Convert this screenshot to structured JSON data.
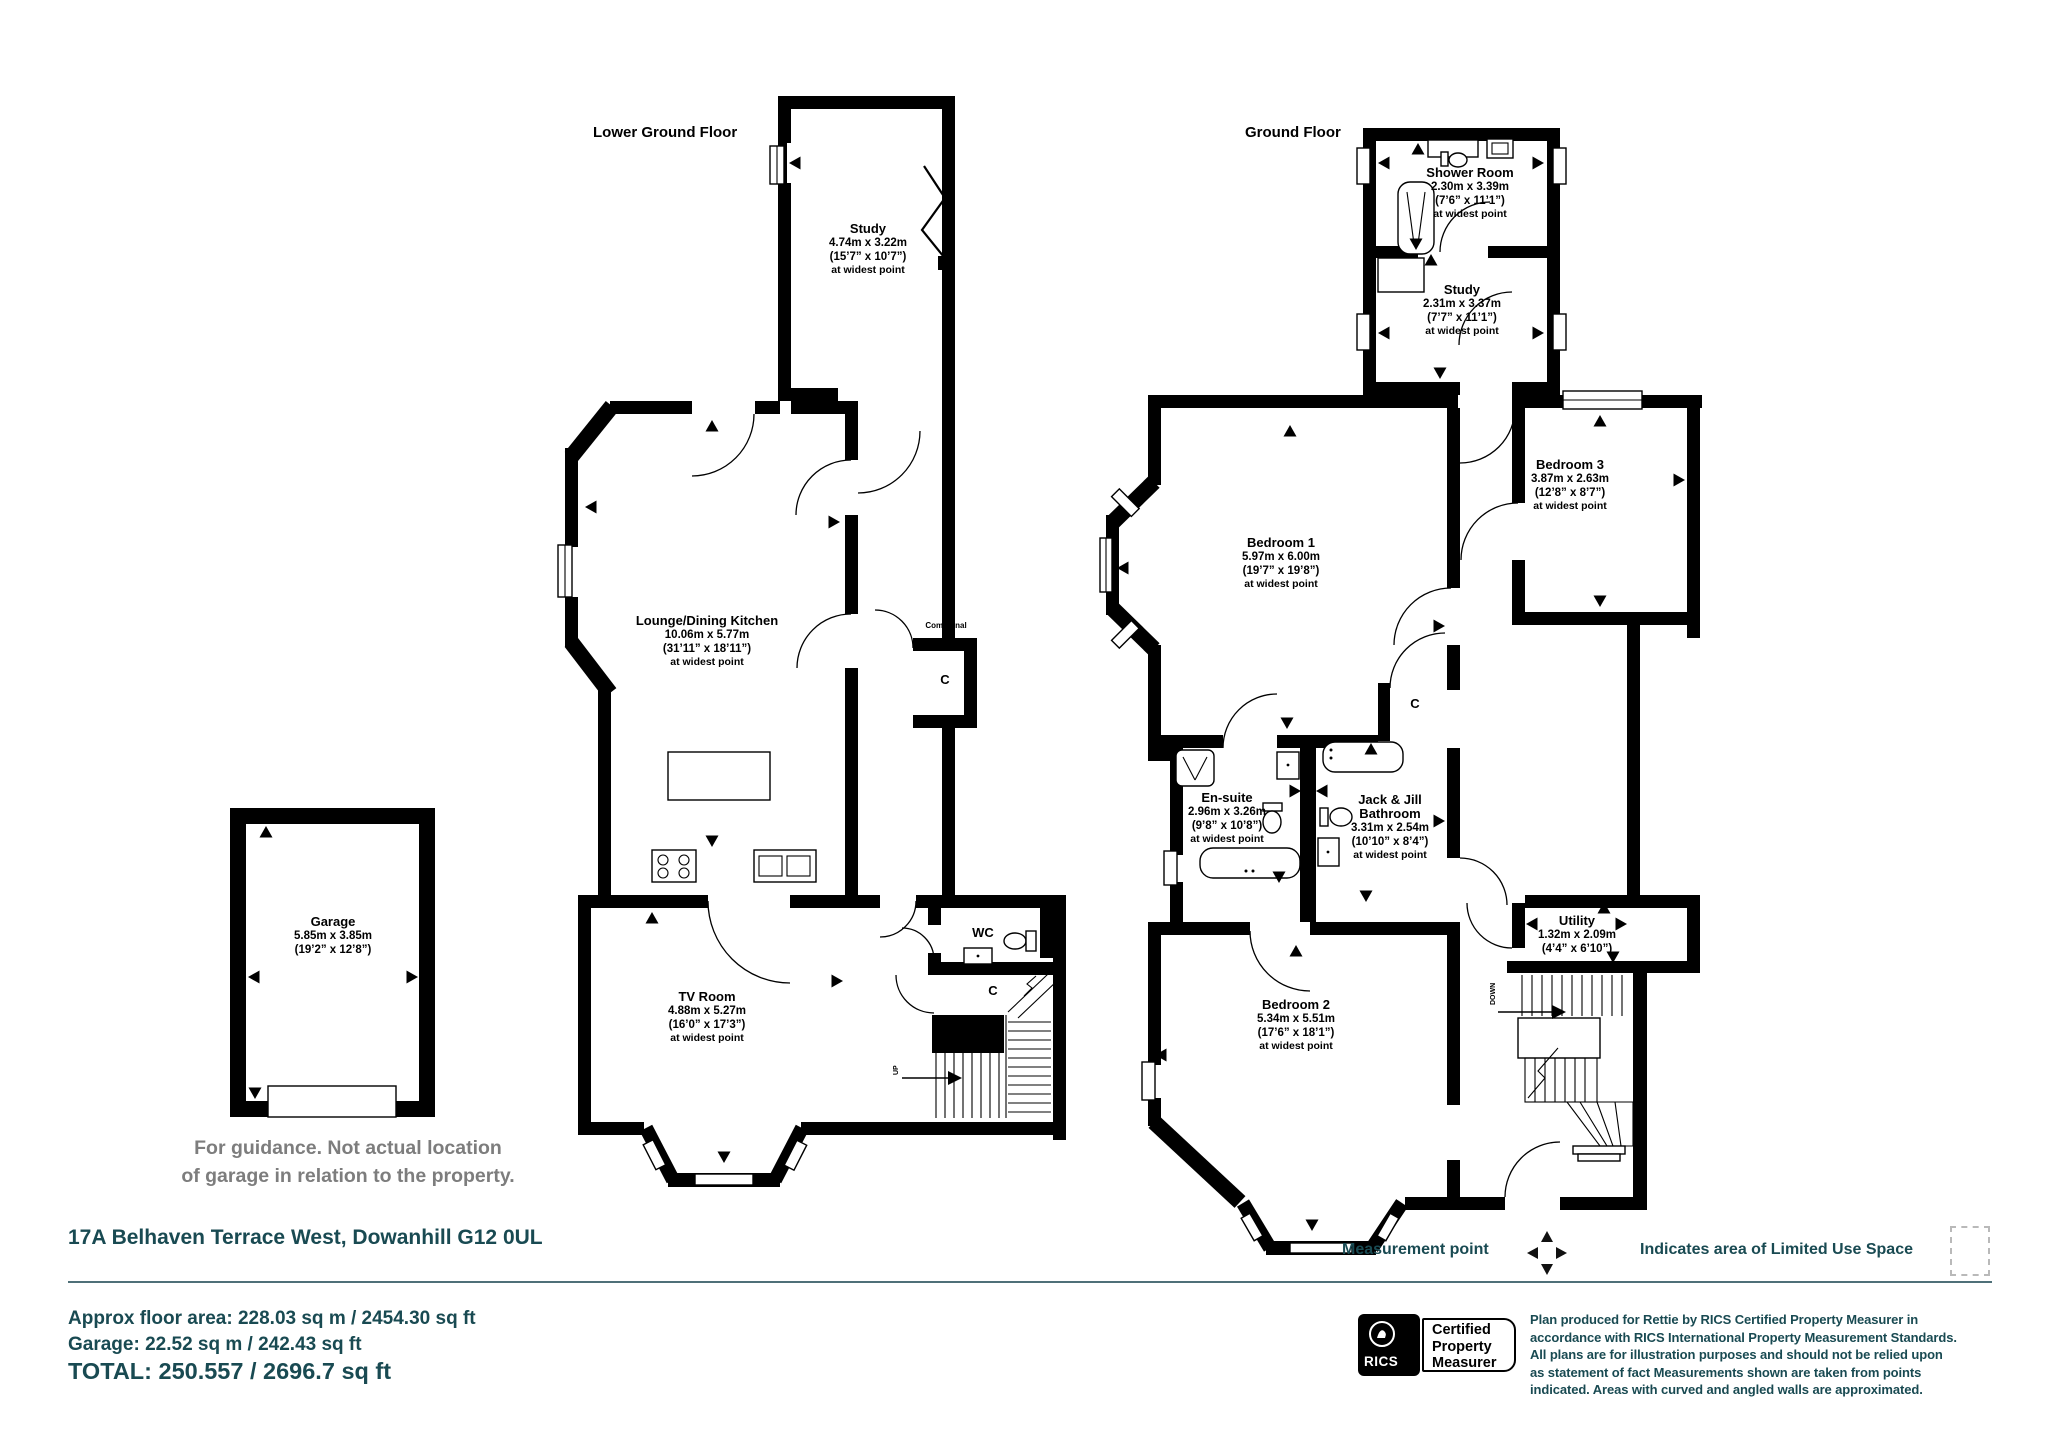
{
  "colors": {
    "teal": "#194a52",
    "gray_note": "#7d7d7d",
    "wall": "#000000",
    "rule_line": "#4f7078"
  },
  "lower": {
    "title": "Lower Ground Floor",
    "study": {
      "name": "Study",
      "m": "4.74m x 3.22m",
      "i": "(15’7” x 10’7”)",
      "w": "at widest point"
    },
    "lounge": {
      "name": "Lounge/Dining Kitchen",
      "m": "10.06m x 5.77m",
      "i": "(31’11” x 18’11”)",
      "w": "at widest point"
    },
    "tv": {
      "name": "TV Room",
      "m": "4.88m x 5.27m",
      "i": "(16’0” x 17’3”)",
      "w": "at widest point"
    },
    "wc": "WC",
    "communal": "Communal",
    "c1": "C",
    "c2": "C",
    "up": "UP"
  },
  "garage": {
    "name": "Garage",
    "m": "5.85m x 3.85m",
    "i": "(19’2” x 12’8”)",
    "note1": "For guidance. Not actual location",
    "note2": "of garage in relation to the property."
  },
  "ground": {
    "title": "Ground Floor",
    "shower": {
      "name": "Shower Room",
      "m": "2.30m x 3.39m",
      "i": "(7’6” x 11’1”)",
      "w": "at widest point"
    },
    "study": {
      "name": "Study",
      "m": "2.31m x 3.37m",
      "i": "(7’7” x 11’1”)",
      "w": "at widest point"
    },
    "bed1": {
      "name": "Bedroom 1",
      "m": "5.97m x 6.00m",
      "i": "(19’7” x 19’8”)",
      "w": "at widest point"
    },
    "bed3": {
      "name": "Bedroom 3",
      "m": "3.87m x 2.63m",
      "i": "(12’8” x 8’7”)",
      "w": "at widest point"
    },
    "ensuite": {
      "name": "En-suite",
      "m": "2.96m x 3.26m",
      "i": "(9’8” x 10’8”)",
      "w": "at widest point"
    },
    "jack": {
      "name1": "Jack & Jill",
      "name2": "Bathroom",
      "m": "3.31m x 2.54m",
      "i": "(10’10” x 8’4”)",
      "w": "at widest point"
    },
    "bed2": {
      "name": "Bedroom 2",
      "m": "5.34m x 5.51m",
      "i": "(17’6” x 18’1”)",
      "w": "at widest point"
    },
    "utility": {
      "name": "Utility",
      "m": "1.32m x 2.09m",
      "i": "(4’4” x 6’10”)"
    },
    "c": "C",
    "down": "DOWN"
  },
  "footer": {
    "address": "17A Belhaven Terrace West, Dowanhill G12 0UL",
    "measurement_label": "Measurement point",
    "limited_label": "Indicates area of  Limited Use Space",
    "area_line1": "Approx floor area: 228.03 sq m / 2454.30 sq ft",
    "area_line2": "Garage: 22.52 sq m / 242.43 sq ft",
    "area_total": "TOTAL: 250.557 / 2696.7 sq ft",
    "rics_logo": "RICS",
    "badge_line1": "Certified",
    "badge_line2": "Property",
    "badge_line3": "Measurer",
    "disclaimer": "Plan produced for Rettie by RICS Certified Property Measurer in accordance with RICS International Property  Measurement Standards.  All plans are for illustration purposes and should not be relied upon as statement of fact Measurements shown are taken from points indicated. Areas with curved and angled walls are approximated."
  }
}
